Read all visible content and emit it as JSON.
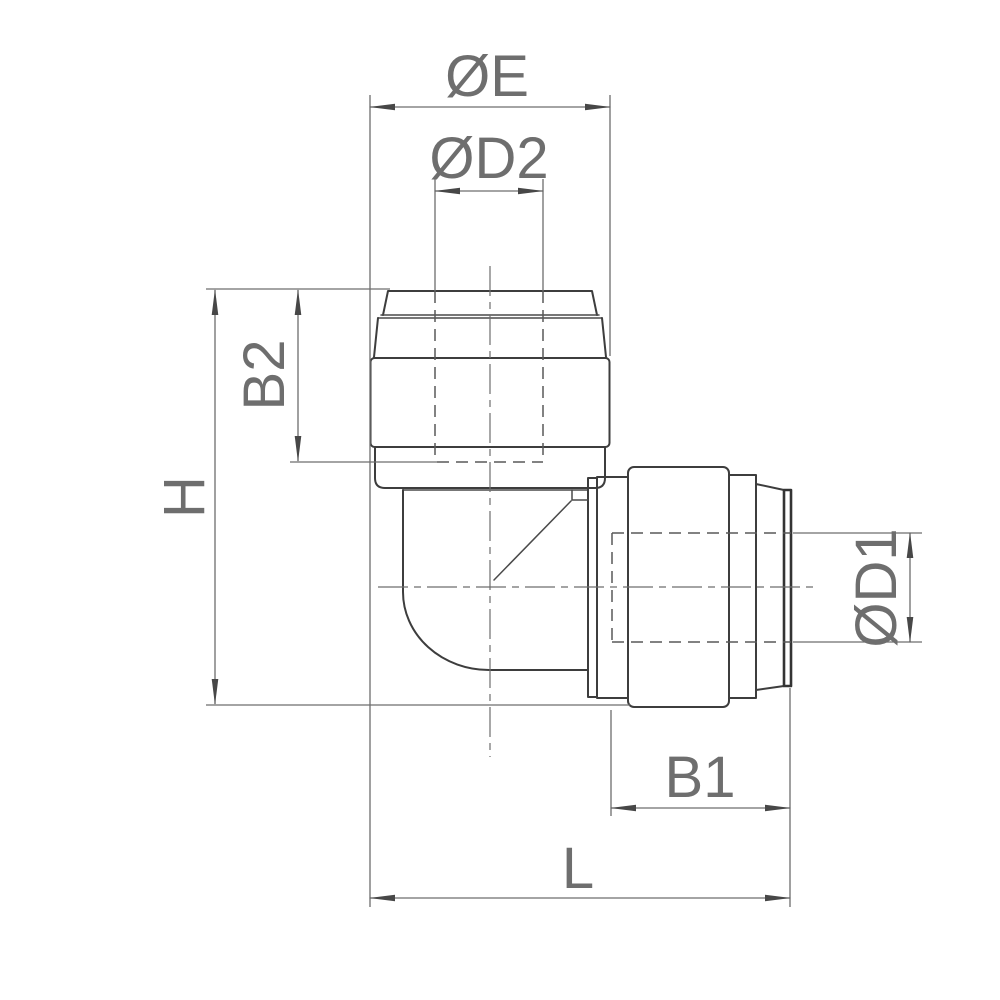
{
  "drawing": {
    "labels": {
      "oe": "ØE",
      "od2": "ØD2",
      "b2": "B2",
      "h": "H",
      "od1": "ØD1",
      "b1": "B1",
      "l": "L"
    },
    "colors": {
      "outline": "#3d3d3d",
      "dimension": "#6d6d6d",
      "text": "#6e6e6e",
      "background": "#ffffff"
    }
  }
}
